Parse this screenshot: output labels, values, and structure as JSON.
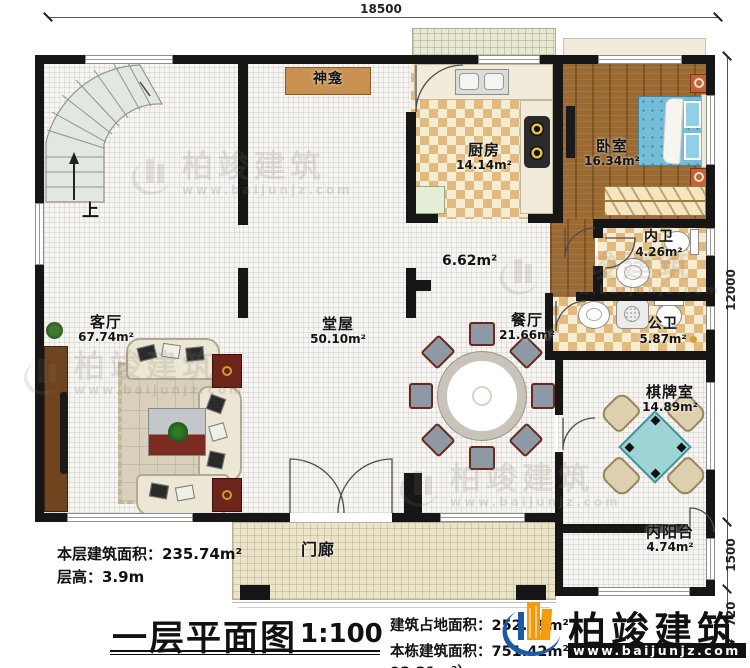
{
  "dimensions": {
    "top": "18500",
    "right_main": "12000",
    "right_mid": "1500",
    "right_bottom": "720"
  },
  "rooms": {
    "living": {
      "name": "客厅",
      "area": "67.74m²"
    },
    "hall": {
      "name": "堂屋",
      "area": "50.10m²"
    },
    "kitchen": {
      "name": "厨房",
      "area": "14.14m²"
    },
    "bedroom": {
      "name": "卧室",
      "area": "16.34m²"
    },
    "inner_bath": {
      "name": "内卫",
      "area": "4.26m²"
    },
    "public_bath": {
      "name": "公卫",
      "area": "5.87m²"
    },
    "dining": {
      "name": "餐厅",
      "area": "21.66m²"
    },
    "chess_room": {
      "name": "棋牌室",
      "area": "14.89m²"
    },
    "inner_balcony": {
      "name": "内阳台",
      "area": "4.74m²"
    },
    "porch": {
      "name": "门廊"
    },
    "shrine": {
      "name": "神龛"
    },
    "corridor": {
      "area": "6.62m²"
    },
    "stair_up": "上"
  },
  "title_block": {
    "floor_area": "本层建筑面积：235.74m²",
    "floor_height": "层高：3.9m",
    "plan_title": "一层平面图",
    "scale": "1:100",
    "site_area": "建筑占地面积：252.49m²",
    "total_area": "本栋建筑面积：751.42m²（包含阁楼面积：93.31m²）"
  },
  "brand": {
    "name": "柏竣建筑",
    "website": "www.baijunjz.com"
  },
  "colors": {
    "brand_blue": "#1b5aa8",
    "brand_orange": "#f49a0e",
    "wall": "#161616",
    "bed_blue": "#74bcd8",
    "mahjong_teal": "#9ed4d6"
  }
}
